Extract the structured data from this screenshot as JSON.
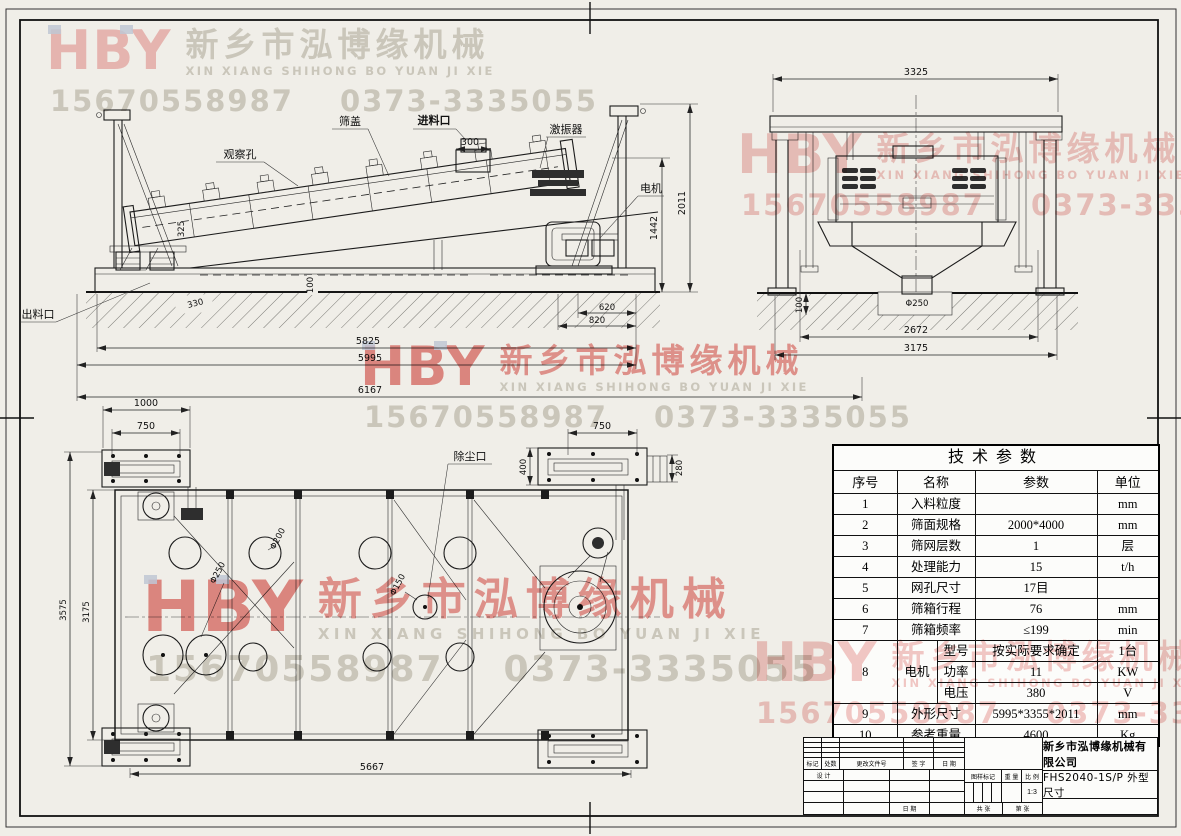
{
  "watermark": {
    "logo": "HBY",
    "company_cn": "新乡市泓博缘机械",
    "company_en": "XIN XIANG SHIHONG BO YUAN JI XIE",
    "phone1": "15670558987",
    "phone2": "0373-3335055",
    "pink": "#efb4b1",
    "red": "#e0625d",
    "gray": "#c7c4ba"
  },
  "labels": {
    "observation_hole": "观察孔",
    "screen_cover": "筛盖",
    "feed_inlet": "进料口",
    "exciter": "激振器",
    "motor": "电机",
    "discharge_outlet": "出料口",
    "dust_port": "除尘口"
  },
  "dims": {
    "s300": "300",
    "s330": "330",
    "s100": "100",
    "s325": "325",
    "s620": "620",
    "s820": "820",
    "s5825": "5825",
    "s5995": "5995",
    "s6167": "6167",
    "s1442": "1442",
    "s2011": "2011",
    "e3325": "3325",
    "e2672": "2672",
    "e3175": "3175",
    "e100": "100",
    "ed250": "Φ250",
    "p1000": "1000",
    "p750a": "750",
    "p750b": "750",
    "p400": "400",
    "p280": "280",
    "p3575": "3575",
    "p3175": "3175",
    "p5667": "5667",
    "pd250": "Φ250",
    "pd200": "Φ200",
    "pd150": "Φ150"
  },
  "table": {
    "title": "技术参数",
    "headers": [
      "序号",
      "名称",
      "参数",
      "单位"
    ],
    "rows": [
      {
        "no": "1",
        "name": "入料粒度",
        "value": "",
        "unit": "mm"
      },
      {
        "no": "2",
        "name": "筛面规格",
        "value": "2000*4000",
        "unit": "mm"
      },
      {
        "no": "3",
        "name": "筛网层数",
        "value": "1",
        "unit": "层"
      },
      {
        "no": "4",
        "name": "处理能力",
        "value": "15",
        "unit": "t/h"
      },
      {
        "no": "5",
        "name": "网孔尺寸",
        "value": "17目",
        "unit": ""
      },
      {
        "no": "6",
        "name": "筛箱行程",
        "value": "76",
        "unit": "mm"
      },
      {
        "no": "7",
        "name": "筛箱频率",
        "value": "≤199",
        "unit": "min"
      },
      {
        "no": "8",
        "name": "电机",
        "sub": "型号",
        "value": "按实际要求确定",
        "unit": "1台"
      },
      {
        "sub": "功率",
        "value": "11",
        "unit": "KW"
      },
      {
        "sub": "电压",
        "value": "380",
        "unit": "V"
      },
      {
        "no": "9",
        "name": "外形尺寸",
        "value": "5995*3355*2011",
        "unit": "mm"
      },
      {
        "no": "10",
        "name": "参考重量",
        "value": "4600",
        "unit": "Kg"
      }
    ]
  },
  "title_block": {
    "company": "新乡市泓博缘机械有限公司",
    "drawing_title": "FHS2040-1S/P  外型尺寸",
    "scale": "1:3",
    "labels": {
      "mark": "标记",
      "count": "处数",
      "change_file": "更改文件号",
      "signature": "签 字",
      "date": "日 期",
      "design": "设 计",
      "date2": "日 期",
      "drawing_mark": "图样标记",
      "weight": "重 量",
      "scale_label": "比 例",
      "sheets": "共  张",
      "sheet_no": "第  张"
    }
  }
}
